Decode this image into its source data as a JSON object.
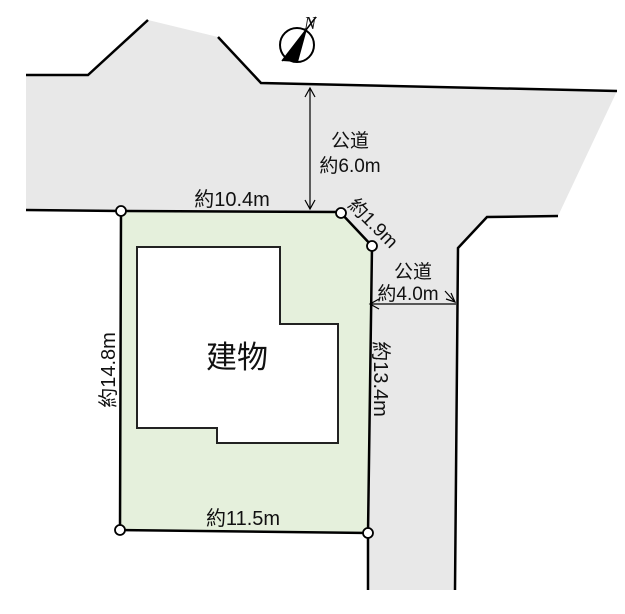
{
  "compass": {
    "north_label": "N"
  },
  "building": {
    "label": "建物"
  },
  "roads": {
    "top": {
      "type_label": "公道",
      "width_label": "約6.0m"
    },
    "side": {
      "type_label": "公道",
      "width_label": "約4.0m"
    }
  },
  "boundaries": {
    "top": "約10.4m",
    "corner_chamfer": "約1.9m",
    "left": "約14.8m",
    "right": "約13.4m",
    "bottom": "約11.5m"
  },
  "colors": {
    "plot_fill": "#e5f0dc",
    "road_fill": "#e8e8e8",
    "building_fill": "#ffffff",
    "line": "#000000"
  }
}
